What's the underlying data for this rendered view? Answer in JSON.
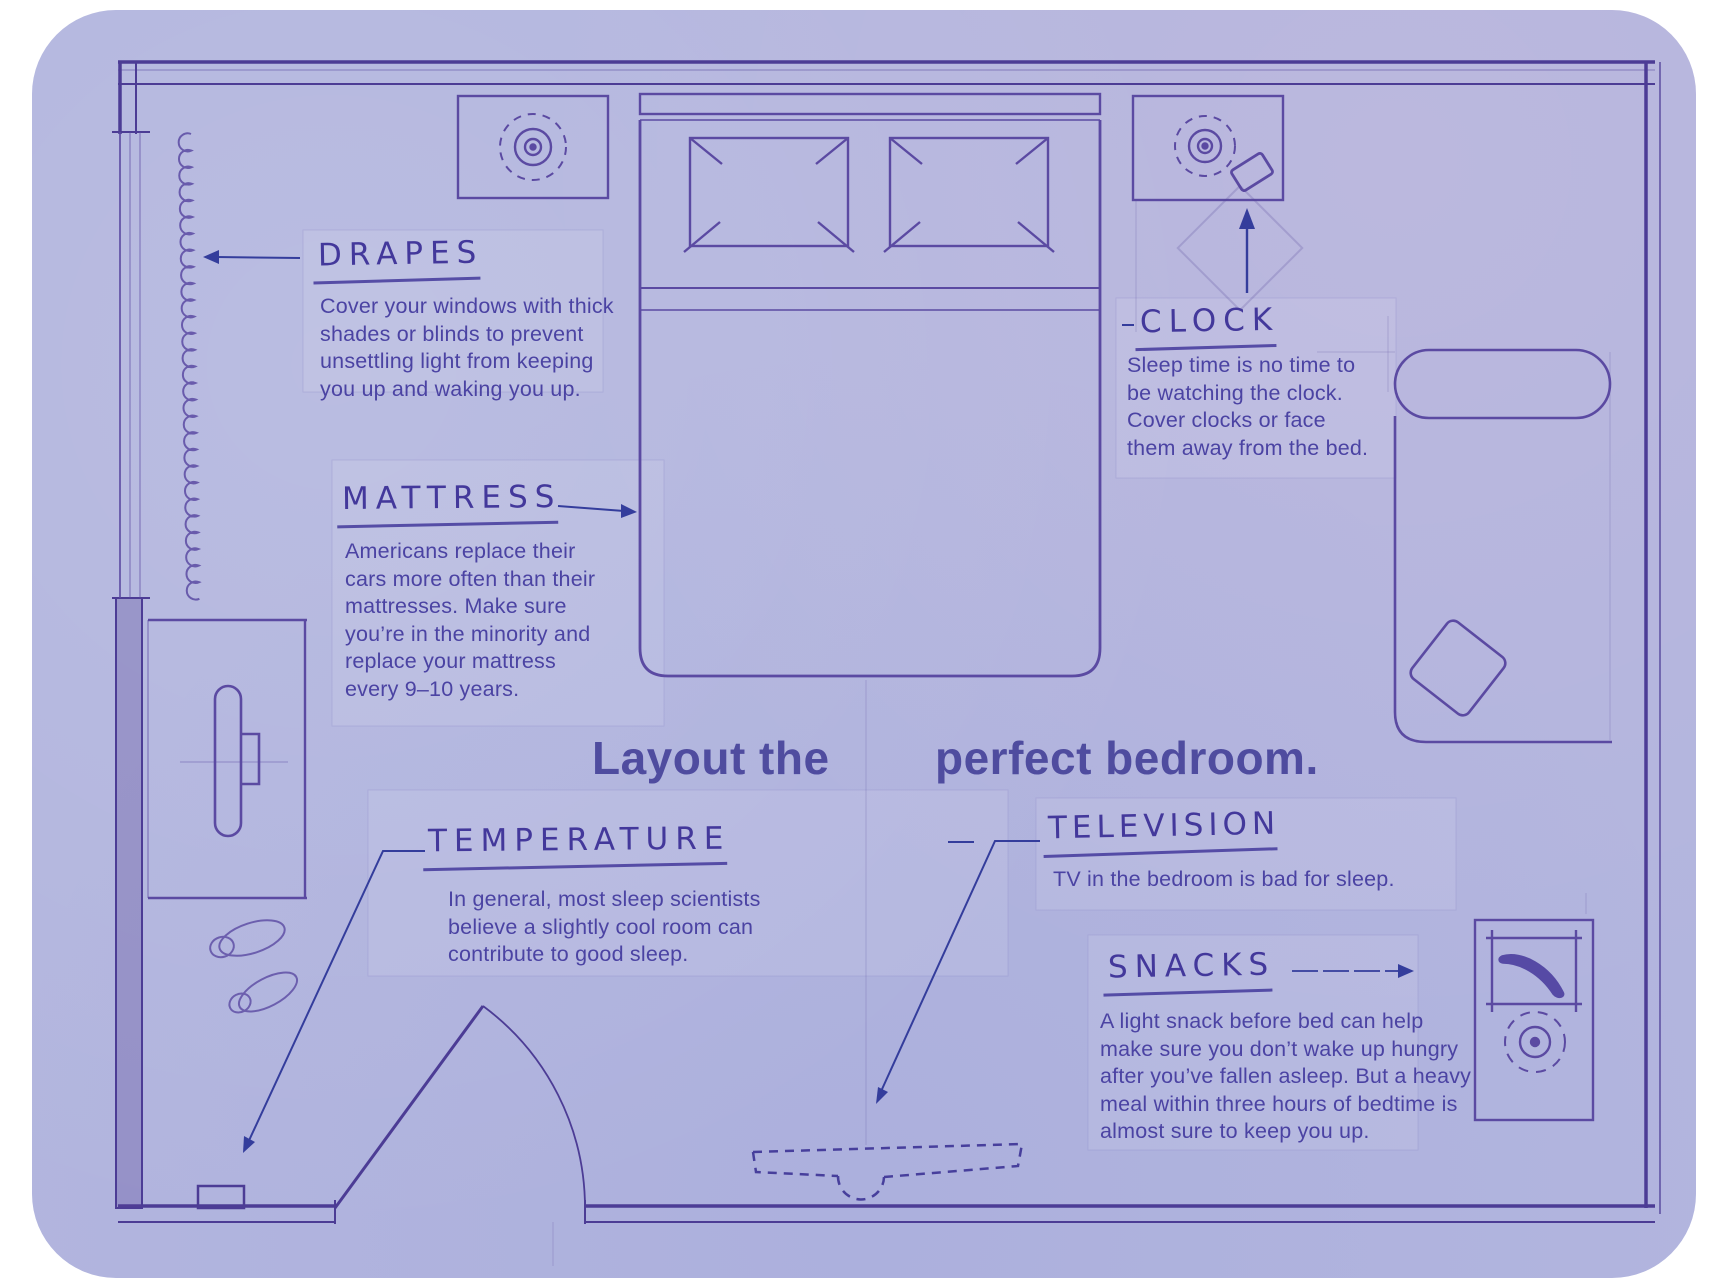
{
  "title": {
    "line_left": "Layout the",
    "line_right": "perfect bedroom."
  },
  "annotations": {
    "drapes": {
      "label": "DRAPES",
      "body": [
        "Cover your windows with thick",
        "shades or blinds to prevent",
        "unsettling light from keeping",
        "you up and waking you up."
      ]
    },
    "mattress": {
      "label": "MATTRESS",
      "body": [
        "Americans replace their",
        "cars more often than their",
        "mattresses. Make sure",
        "you’re in the minority and",
        "replace your mattress",
        "every 9–10 years."
      ]
    },
    "clock": {
      "label": "CLOCK",
      "body": [
        "Sleep time is no time to",
        "be watching the clock.",
        "Cover clocks or face",
        "them away from the bed."
      ]
    },
    "temperature": {
      "label": "TEMPERATURE",
      "body": [
        "In general, most sleep scientists",
        "believe a slightly cool room can",
        "contribute to good sleep."
      ]
    },
    "television": {
      "label": "TELEVISION",
      "body": [
        "TV in the bedroom is bad for sleep."
      ]
    },
    "snacks": {
      "label": "SNACKS",
      "body": [
        "A light snack before bed can help",
        "make sure you don’t wake up hungry",
        "after you’ve fallen asleep. But a heavy",
        "meal within three hours of bedtime is",
        "almost sure to keep you up."
      ]
    }
  },
  "furniture_icons": [
    "bed",
    "pillow",
    "headboard",
    "nightstand",
    "lamp-icon",
    "alarm-clock-icon",
    "chaise-lounge",
    "cushion",
    "tv-stand",
    "television-icon",
    "slippers-icon",
    "door",
    "door-swing-arc",
    "thermostat",
    "window-drapes-icon",
    "snack-station",
    "banana-icon",
    "plate-icon",
    "ceiling-tv-dashed"
  ],
  "colors": {
    "page": "#ffffff",
    "blueprint_background": "#b2b5de",
    "plan_ink": "#5b4aa2",
    "wall_ink": "#4c3c95",
    "body_text": "#4b43a3",
    "label_ink": "#43389b",
    "title_ink": "#4f4c9f",
    "arrow_ink": "#343d9c"
  }
}
